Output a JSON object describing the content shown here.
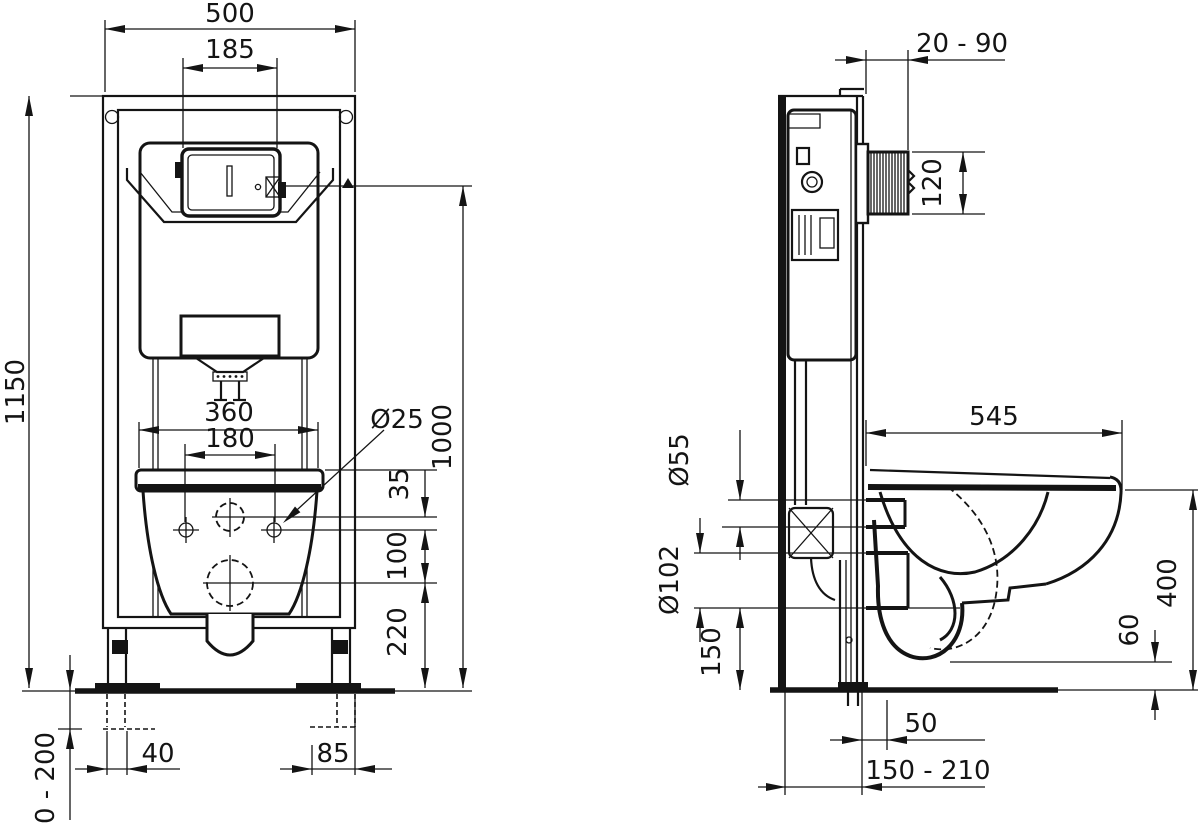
{
  "drawing": {
    "type": "technical installation drawing, wall-hung WC frame",
    "line_color": "#141414",
    "background_color": "#ffffff",
    "front_view": {
      "dims": {
        "frame_width": "500",
        "flush_plate_width": "185",
        "frame_height": "1150",
        "bowl_width": "360",
        "bolt_spacing": "180",
        "bolt_diameter": "Ø25",
        "actuator_height": "1000",
        "spacing_35": "35",
        "spacing_100": "100",
        "outlet_height": "220",
        "left_foot_offset": "40",
        "right_foot_offset": "85",
        "foot_adjust_range": "0 - 200"
      }
    },
    "side_view": {
      "dims": {
        "wall_finish_range": "20 - 90",
        "plate_housing_height": "120",
        "bowl_depth": "545",
        "flush_pipe_diameter": "Ø55",
        "outlet_diameter": "Ø102",
        "outlet_center_height": "150",
        "rim_height": "400",
        "bowl_floor_clearance": "60",
        "outlet_wall_offset": "50",
        "drain_wall_range": "150 - 210"
      }
    }
  }
}
